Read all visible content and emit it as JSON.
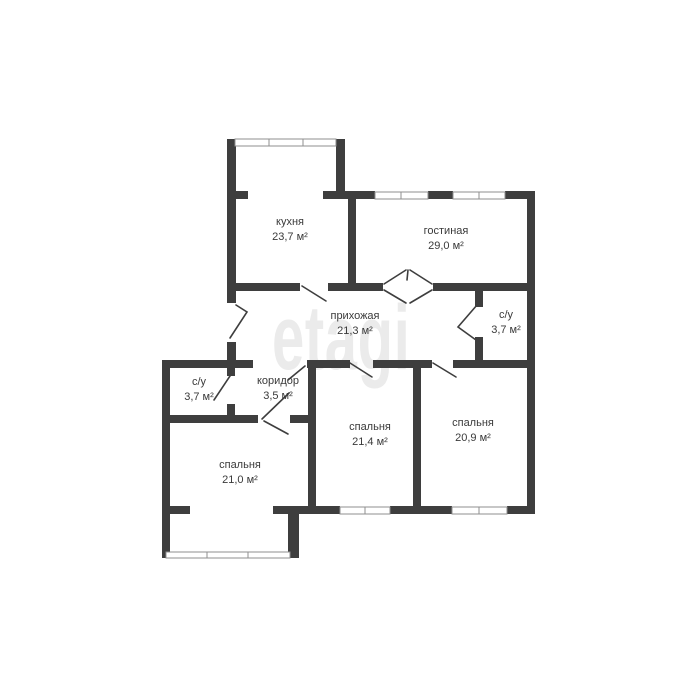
{
  "watermark": "etagi",
  "colors": {
    "wall": "#3e3e3e",
    "window_frame": "#8f8f8f",
    "label_text": "#3a3a3a",
    "watermark": "#ebebeb",
    "background": "#ffffff"
  },
  "rooms": [
    {
      "id": "kitchen",
      "name": "кухня",
      "area": "23,7 м²"
    },
    {
      "id": "living-room",
      "name": "гостиная",
      "area": "29,0 м²"
    },
    {
      "id": "hallway",
      "name": "прихожая",
      "area": "21,3 м²"
    },
    {
      "id": "bathroom-right",
      "name": "с/у",
      "area": "3,7 м²"
    },
    {
      "id": "corridor",
      "name": "коридор",
      "area": "3,5 м²"
    },
    {
      "id": "bathroom-left",
      "name": "с/у",
      "area": "3,7 м²"
    },
    {
      "id": "bedroom-left",
      "name": "спальня",
      "area": "21,0 м²"
    },
    {
      "id": "bedroom-middle",
      "name": "спальня",
      "area": "21,4 м²"
    },
    {
      "id": "bedroom-right",
      "name": "спальня",
      "area": "20,9 м²"
    }
  ]
}
